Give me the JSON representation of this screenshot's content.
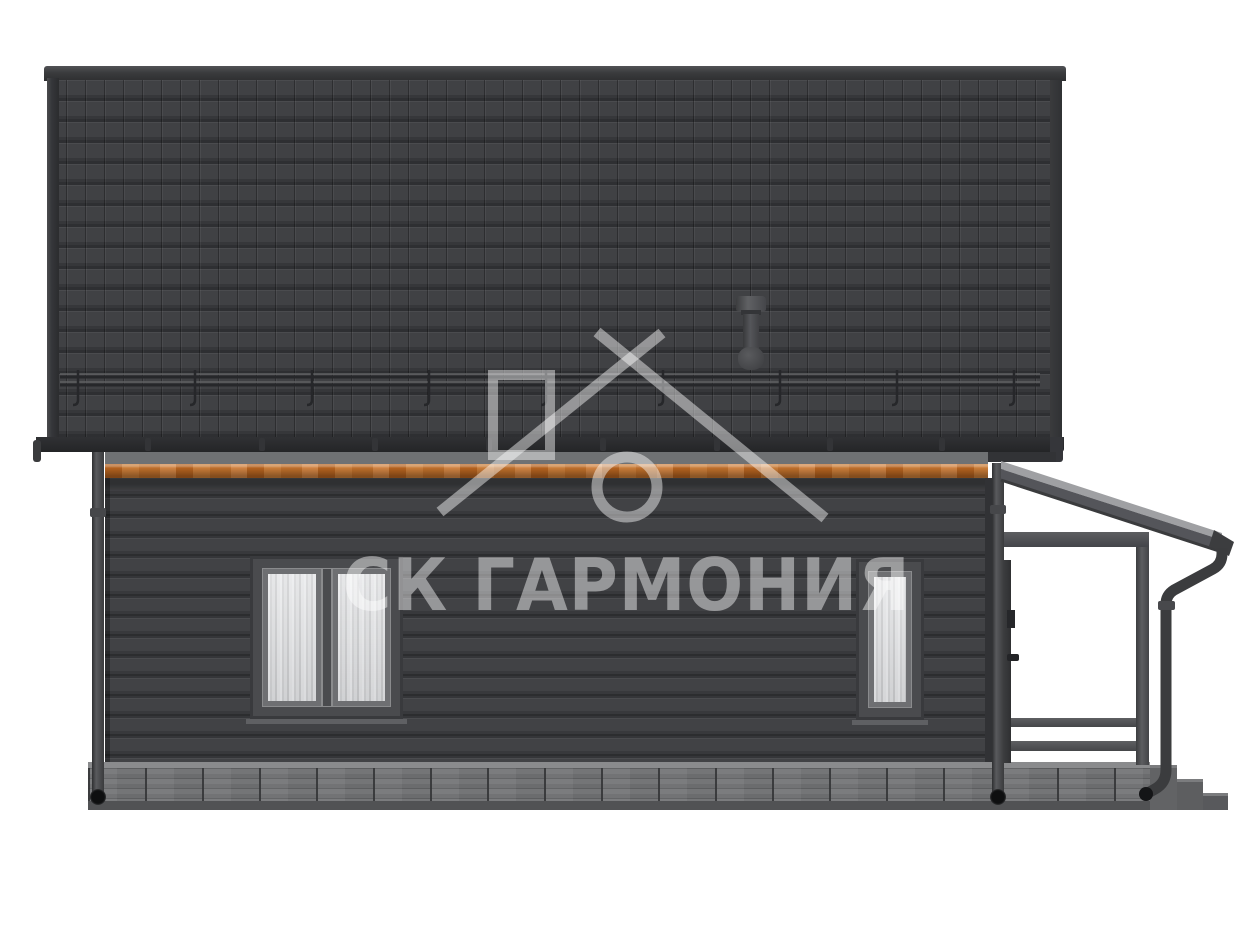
{
  "scene": {
    "type": "architectural-elevation-render",
    "view": "side elevation of a house",
    "background": "#ffffff"
  },
  "watermark": {
    "text": "СК ГАРМОНИЯ",
    "logo": "house-outline-with-chimney-and-ring",
    "color": "rgba(255,255,255,0.45)"
  },
  "house": {
    "roof": {
      "material": "tile",
      "color": "#3e3f41",
      "ridge_color": "#333436",
      "snow_guard": "yes",
      "vent_pipe": "yes"
    },
    "fascia": {
      "wood_color": "#c0742f"
    },
    "wall": {
      "siding": "horizontal-lap",
      "color": "#3f4042"
    },
    "windows": [
      {
        "id": "left",
        "panes": 2
      },
      {
        "id": "right",
        "panes": 1
      }
    ],
    "foundation": {
      "material": "brick",
      "color": "#717274"
    },
    "porch": {
      "side": "right",
      "roof": "mono-pitch",
      "posts": 1,
      "railing_rails": 2,
      "steps": 3
    },
    "downspouts": 3
  }
}
